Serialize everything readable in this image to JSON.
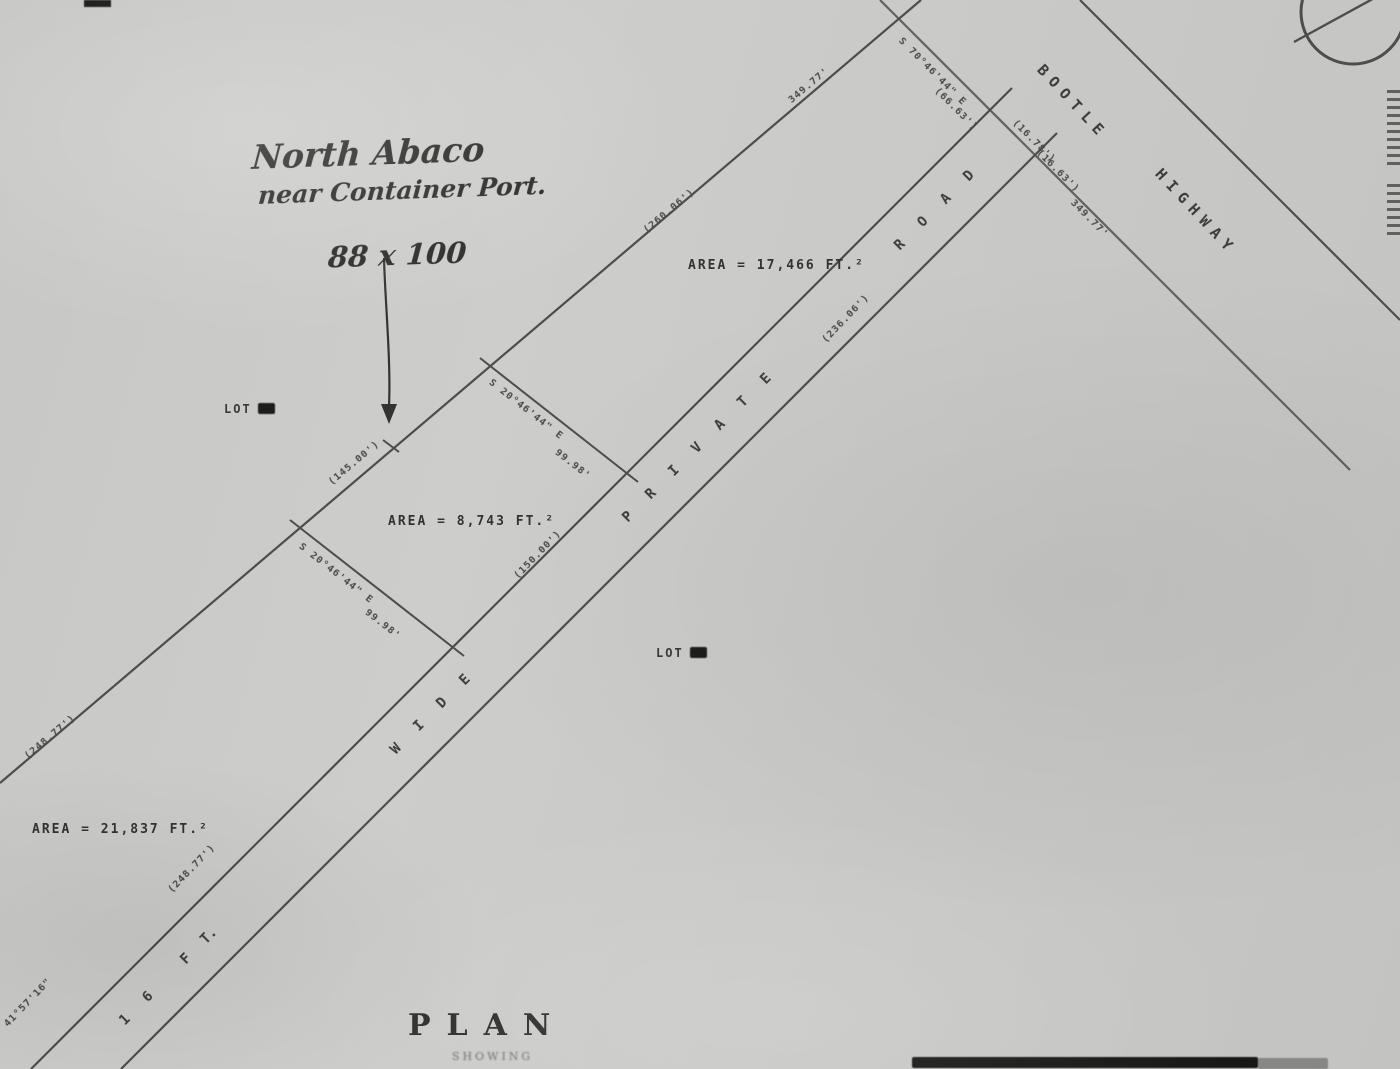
{
  "title_block": {
    "title": "PLAN",
    "subtitle": "SHOWING"
  },
  "handwriting": {
    "line1": "North Abaco",
    "line2": "near Container Port.",
    "dimensions": "88 x 100"
  },
  "highway": {
    "words": [
      "BOOTLE",
      "HIGHWAY"
    ]
  },
  "road": {
    "full_name": "16 FT. WIDE PRIVATE ROAD",
    "letters": [
      "1",
      "6",
      "F",
      "T.",
      "W",
      "I",
      "D",
      "E",
      "P",
      "R",
      "I",
      "V",
      "A",
      "T",
      "E",
      "R",
      "O",
      "A",
      "D"
    ]
  },
  "lots": {
    "areas": [
      "AREA  =  21,837 FT.²",
      "AREA  =  8,743 FT.²",
      "AREA  =  17,466 FT.²"
    ]
  },
  "lot_markers": [
    "LOT",
    "LOT"
  ],
  "measurements": [
    "(248.77')",
    "(248.77')",
    "41°57'16\"",
    "(145.00')",
    "(260.06')",
    "349.77'",
    "S 70°46'44\" E",
    "(66.63')",
    "(16.78')",
    "(16.63')",
    "349.77'",
    "(236.06')",
    "S 20°46'44\" E",
    "99.98'",
    "S 20°46'44\" E",
    "99.98'",
    "(150.00')"
  ]
}
